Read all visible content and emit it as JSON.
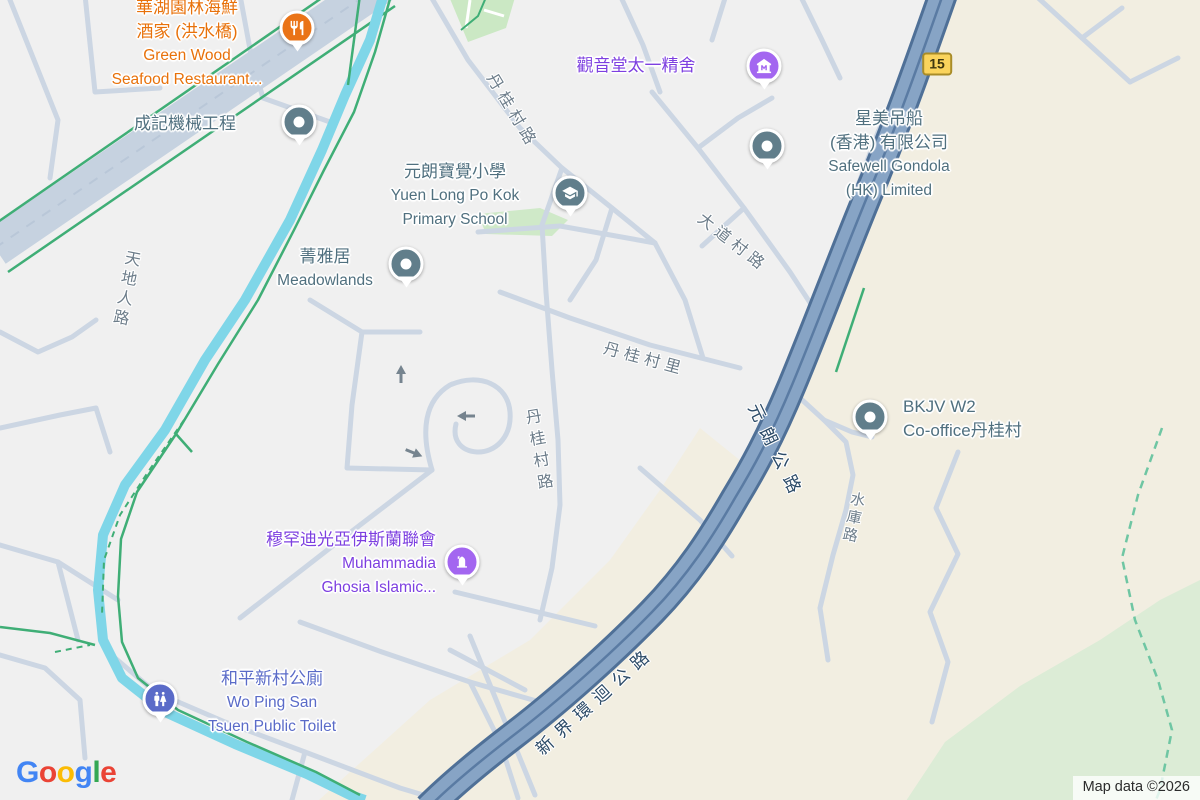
{
  "map": {
    "attribution": "Map data ©2026",
    "route_shield": "15",
    "logo": {
      "letters": [
        "G",
        "o",
        "o",
        "g",
        "l",
        "e"
      ],
      "colors": [
        "#4285F4",
        "#EA4335",
        "#FBBC05",
        "#4285F4",
        "#34A853",
        "#EA4335"
      ]
    },
    "colors": {
      "poi_default": "#50707f",
      "restaurant": "#e8710a",
      "worship_text": "#7d3fe0",
      "worship_pin": "#a366f0",
      "civic": "#5a6bc8",
      "pin_default": "#617e8b",
      "road_label": "#6d7d8a",
      "highway_label": "#2b4a67",
      "highway_fill": "#87a4c5",
      "road_minor": "#ccd6e3",
      "stream": "#7fd6e8",
      "path_green": "#3fae76",
      "terrain": "#f2eee1",
      "park": "#dcecd6",
      "shield_bg": "#fbd45c"
    },
    "pois": [
      {
        "name": "green-wood-seafood-restaurant",
        "pin_icon": "restaurant",
        "lines": [
          "華湖園林海鮮",
          "酒家 (洪水橋)",
          "Green Wood",
          "Seafood Restaurant..."
        ],
        "color": "#e8710a",
        "pin_color": "#ea7317"
      },
      {
        "name": "shing-kee-machinery",
        "pin_icon": "dot",
        "lines": [
          "成記機械工程"
        ],
        "color": "#50707f",
        "pin_color": "#617e8b"
      },
      {
        "name": "kwun-yum-tong",
        "pin_icon": "museum",
        "lines": [
          "觀音堂太一精舍"
        ],
        "color": "#7d3fe0",
        "pin_color": "#a366f0"
      },
      {
        "name": "safewell-gondola",
        "pin_icon": "dot",
        "lines": [
          "星美吊船",
          "(香港) 有限公司",
          "Safewell Gondola",
          "(HK) Limited"
        ],
        "color": "#50707f",
        "pin_color": "#617e8b"
      },
      {
        "name": "po-kok-primary-school",
        "pin_icon": "school",
        "lines": [
          "元朗寶覺小學",
          "Yuen Long Po Kok",
          "Primary School"
        ],
        "color": "#50707f",
        "pin_color": "#617e8b"
      },
      {
        "name": "meadowlands",
        "pin_icon": "dot",
        "lines": [
          "菁雅居",
          "Meadowlands"
        ],
        "color": "#50707f",
        "pin_color": "#617e8b"
      },
      {
        "name": "bkjv-w2-co-office",
        "pin_icon": "dot",
        "lines": [
          "BKJV W2",
          "Co-office丹桂村"
        ],
        "color": "#50707f",
        "pin_color": "#617e8b"
      },
      {
        "name": "muhammadia-ghosia-islamic",
        "pin_icon": "worship",
        "lines": [
          "穆罕迪光亞伊斯蘭聯會",
          "Muhammadia",
          "Ghosia Islamic..."
        ],
        "color": "#7d3fe0",
        "pin_color": "#a366f0"
      },
      {
        "name": "wo-ping-san-tsuen-public-toilet",
        "pin_icon": "wc",
        "lines": [
          "和平新村公廁",
          "Wo Ping San",
          "Tsuen Public Toilet"
        ],
        "color": "#5a6bc8",
        "pin_color": "#5a6bc8"
      }
    ],
    "road_labels": [
      {
        "text": "丹桂村路"
      },
      {
        "text": "天地人路"
      },
      {
        "text": "大道村路"
      },
      {
        "text": "丹桂村里"
      },
      {
        "text": "丹桂村路"
      },
      {
        "text": "元朗公路"
      },
      {
        "text": "水庫路"
      },
      {
        "text": "新界環迴公路"
      }
    ]
  }
}
